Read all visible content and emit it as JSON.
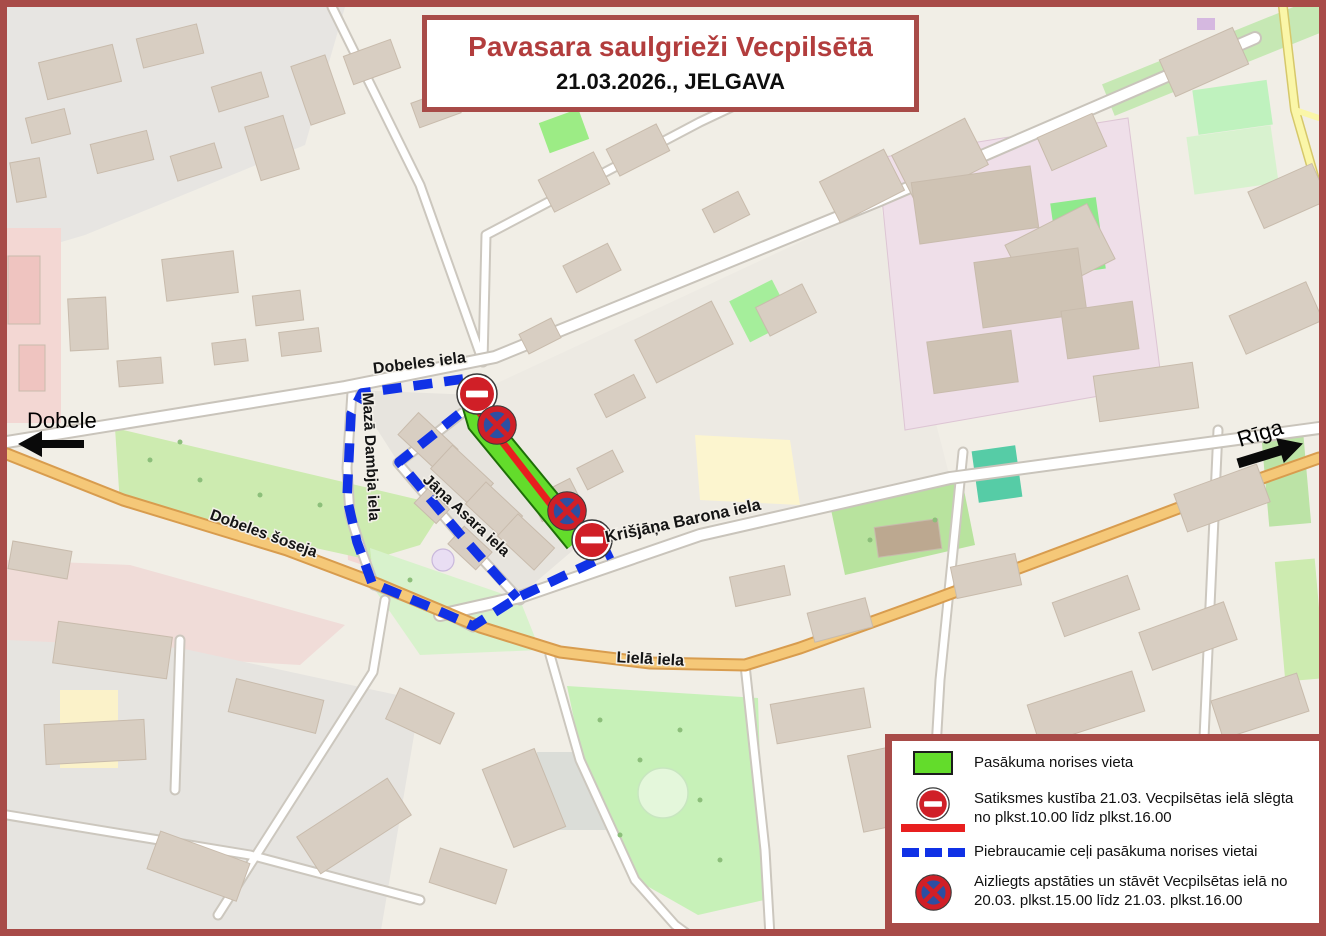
{
  "title_box": {
    "title": "Pavasara saulgrieži Vecpilsētā",
    "subtitle": "21.03.2026., JELGAVA"
  },
  "direction_arrows": {
    "west_label": "Dobele",
    "east_label": "Rīga"
  },
  "street_labels": {
    "dobeles_iela": "Dobeles iela",
    "maza_dambja_iela": "Mazā Dambja iela",
    "jana_asara_iela": "Jāņa Asara iela",
    "krisjana_barona_iela": "Krišjāņa Barona iela",
    "dobeles_soseja": "Dobeles šoseja",
    "liela_iela": "Lielā iela"
  },
  "legend": {
    "items": [
      {
        "icon": "event-area-swatch",
        "label": "Pasākuma norises vieta"
      },
      {
        "icon": "no-entry-sign-with-closed-road-line",
        "label": "Satiksmes kustība 21.03. Vecpilsētas ielā slēgta no plkst.10.00 līdz plkst.16.00"
      },
      {
        "icon": "blue-dashed-line",
        "label": "Piebraucamie ceļi pasākuma norises vietai"
      },
      {
        "icon": "no-stopping-sign",
        "label": "Aizliegts apstāties un stāvēt Vecpilsētas ielā no 20.03. plkst.15.00 līdz 21.03. plkst.16.00"
      }
    ]
  },
  "map_markers": {
    "no_entry_signs": 2,
    "no_stopping_signs": 2
  },
  "colors": {
    "accent_red": "#a84b48",
    "title_red": "#b23d3d",
    "route_blue": "#1031e6",
    "event_green": "#63dc2b",
    "closed_red": "#e81f1f",
    "sign_red": "#d01f27",
    "sign_blue": "#2d4fa2"
  }
}
